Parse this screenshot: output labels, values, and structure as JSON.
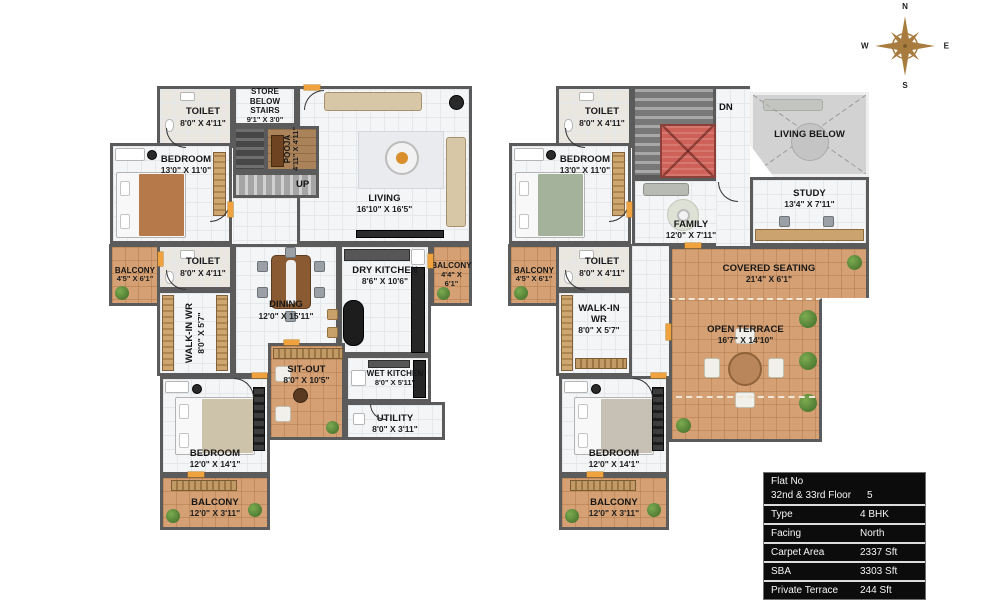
{
  "compass": {
    "n": "N",
    "e": "E",
    "s": "S",
    "w": "W"
  },
  "info_table": {
    "row0": {
      "line1": "Flat No",
      "line2": "32nd & 33rd Floor",
      "value": "5"
    },
    "rows": [
      {
        "label": "Type",
        "value": "4 BHK"
      },
      {
        "label": "Facing",
        "value": "North"
      },
      {
        "label": "Carpet Area",
        "value": "2337 Sft"
      },
      {
        "label": "SBA",
        "value": "3303 Sft"
      },
      {
        "label": "Private Terrace",
        "value": "244 Sft"
      }
    ]
  },
  "plans": {
    "lower": {
      "stairs_label": "UP",
      "rooms": {
        "toilet_top": {
          "name": "TOILET",
          "dims": "8'0\" X 4'11\""
        },
        "store": {
          "name": "STORE BELOW STAIRS",
          "dims": "9'1\" X 3'0\""
        },
        "pooja": {
          "name": "POOJA",
          "dims": "4'11\" X 4'11\""
        },
        "living": {
          "name": "LIVING",
          "dims": "16'10\" X 16'5\""
        },
        "bedroom_top": {
          "name": "BEDROOM",
          "dims": "13'0\" X 11'0\""
        },
        "balcony_left": {
          "name": "BALCONY",
          "dims": "4'5\" X 6'1\""
        },
        "toilet_mid": {
          "name": "TOILET",
          "dims": "8'0\" X 4'11\""
        },
        "walk_in": {
          "name": "WALK-IN WR",
          "dims": "8'0\" X 5'7\""
        },
        "dining": {
          "name": "DINING",
          "dims": "12'0\" X 15'11\""
        },
        "dry_kitchen": {
          "name": "DRY KITCHEN",
          "dims": "8'6\" X 10'6\""
        },
        "balcony_right": {
          "name": "BALCONY",
          "dims": "4'4\" X 6'1\""
        },
        "sit_out": {
          "name": "SIT-OUT",
          "dims": "8'0\" X 10'5\""
        },
        "wet_kitchen": {
          "name": "WET KITCHEN",
          "dims": "8'0\" X 5'11\""
        },
        "utility": {
          "name": "UTILITY",
          "dims": "8'0\" X 3'11\""
        },
        "bedroom_bottom": {
          "name": "BEDROOM",
          "dims": "12'0\" X 14'1\""
        },
        "balcony_bottom": {
          "name": "BALCONY",
          "dims": "12'0\" X 3'11\""
        }
      }
    },
    "upper": {
      "stairs_label": "DN",
      "rooms": {
        "toilet_top": {
          "name": "TOILET",
          "dims": "8'0\" X 4'11\""
        },
        "bedroom_top": {
          "name": "BEDROOM",
          "dims": "13'0\" X 11'0\""
        },
        "living_below": {
          "name": "LIVING BELOW"
        },
        "study": {
          "name": "STUDY",
          "dims": "13'4\" X 7'11\""
        },
        "family": {
          "name": "FAMILY",
          "dims": "12'0\" X 7'11\""
        },
        "balcony_left": {
          "name": "BALCONY",
          "dims": "4'5\" X 6'1\""
        },
        "toilet_mid": {
          "name": "TOILET",
          "dims": "8'0\" X 4'11\""
        },
        "walk_in": {
          "name": "WALK-IN WR",
          "dims": "8'0\" X 5'7\""
        },
        "covered_seating": {
          "name": "COVERED SEATING",
          "dims": "21'4\" X 6'1\""
        },
        "open_terrace": {
          "name": "OPEN TERRACE",
          "dims": "16'7\" X 14'10\""
        },
        "bedroom_bottom": {
          "name": "BEDROOM",
          "dims": "12'0\" X 14'1\""
        },
        "balcony_bottom": {
          "name": "BALCONY",
          "dims": "12'0\" X 3'11\""
        }
      }
    }
  },
  "colors": {
    "wall": "#5c5b5b",
    "floor": "#f4f5f7",
    "balcony": "#d5a174",
    "roof": "#cf6258",
    "door": "#efa23d",
    "compass": "#a87c3e",
    "table_bg": "#0c0c0c",
    "text": "#141414"
  }
}
